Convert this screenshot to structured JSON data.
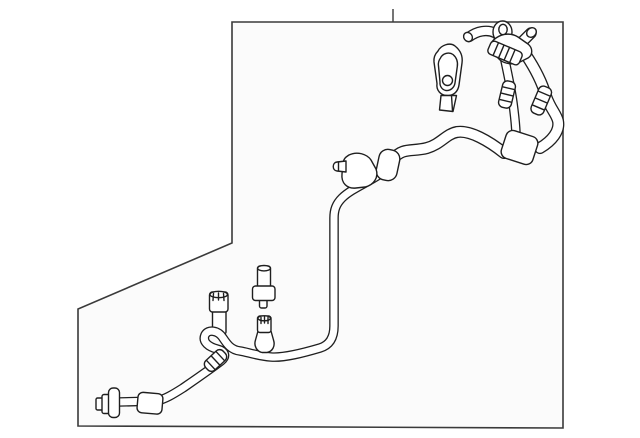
{
  "diagram": {
    "kind": "parts-line-drawing",
    "subject": "ac-suction-discharge-hose-assembly",
    "canvas": {
      "width": 640,
      "height": 438,
      "background": "#ffffff"
    },
    "colors": {
      "line": "#1f1f1f",
      "frame_line": "#3a3a3a",
      "frame_fill": "#fbfbfb",
      "part_fill": "#ffffff"
    },
    "frame": {
      "points": "232,22 563,22 563,428 78,426 78,309 232,243",
      "tick": {
        "x": 393,
        "y1": 9,
        "y2": 22
      }
    },
    "under": [
      {
        "name": "service-port-neck",
        "kind": "rect",
        "attrs": {
          "x": 212.5,
          "y": 306,
          "width": 13.5,
          "height": 28,
          "rx": 2
        }
      },
      {
        "name": "service-port-cap",
        "kind": "rect",
        "attrs": {
          "x": 209.5,
          "y": 292,
          "width": 18.5,
          "height": 20,
          "rx": 3
        }
      },
      {
        "name": "service-port-cap-top",
        "kind": "ellipse",
        "attrs": {
          "cx": 218.7,
          "cy": 294.5,
          "rx": 8.7,
          "ry": 3.2
        }
      },
      {
        "name": "port-knurl-tick-1",
        "kind": "line",
        "attrs": {
          "x1": 213.5,
          "y1": 293.5,
          "x2": 213,
          "y2": 300.5
        }
      },
      {
        "name": "port-knurl-tick-2",
        "kind": "line",
        "attrs": {
          "x1": 218.5,
          "y1": 293,
          "x2": 218.5,
          "y2": 300
        }
      },
      {
        "name": "port-knurl-tick-3",
        "kind": "line",
        "attrs": {
          "x1": 223.5,
          "y1": 293.5,
          "x2": 224,
          "y2": 300.5
        }
      }
    ],
    "tubes": [
      {
        "name": "manifold-gooseneck-tube",
        "w": 8,
        "d": "M469,37 C477,31 487,29 495,33 C502,37 507,43 510,51"
      },
      {
        "name": "service-port-stub",
        "w": 9,
        "d": "M521,43 L531,33"
      },
      {
        "name": "steep-tube-run",
        "w": 7,
        "d": "M504,56 C507,70 511,88 513,103 C515,118 516,127 516,136"
      },
      {
        "name": "right-loop-hose",
        "w": 9.5,
        "d": "M526,55 C534,67 542,82 546,96 C551,110 556,113 558,121 C560,131 552,141 540,148"
      },
      {
        "name": "upper-hose-run",
        "w": 9.5,
        "d": "M504,153 C489,141 470,130 457,132 C446,134 441,144 427,148 C412,152 403,147 393,159"
      },
      {
        "name": "lower-tube-run",
        "w": 7,
        "d": "M386,170 C372,181 352,188 342,198 C336,204 334,210 334,218 L334,326 C334,337 330,345 320,348 C303,353 284,358 271,357 C258,356 247,352 240,351 C231,350 227,344 223,338 C218,330 208,329 205,335 C202,342 209,347 217,349 C225,351 227,356 221,361 C212,368 196,379 183,388 C172,395 165,399 157,401 L118,402"
      }
    ],
    "details": [
      {
        "name": "bracket-eyelet-outer",
        "kind": "ellipse",
        "attrs": {
          "cx": 502.5,
          "cy": 32,
          "rx": 9.5,
          "ry": 11
        }
      },
      {
        "name": "bracket-eyelet-inner",
        "kind": "ellipse",
        "fill": "none",
        "attrs": {
          "cx": 503,
          "cy": 29.5,
          "rx": 4.2,
          "ry": 5.2
        }
      },
      {
        "name": "gooseneck-tip",
        "kind": "ellipse",
        "attrs": {
          "cx": 468,
          "cy": 37,
          "rx": 4.2,
          "ry": 4.8,
          "transform": "rotate(-35 468 37)"
        }
      },
      {
        "name": "manifold-bracket",
        "kind": "path",
        "attrs": {
          "d": "M496,38 C503,33 512,33 518,37 L528,44 C533,48 533,55 528,58 L520,62 C513,65 505,64 500,60 L493,53 C489,48 490,42 496,38 Z"
        }
      },
      {
        "name": "port-stub-cap",
        "kind": "ellipse",
        "attrs": {
          "cx": 531.5,
          "cy": 32.5,
          "rx": 4.4,
          "ry": 5.2,
          "transform": "rotate(45 531.5 32.5)"
        }
      },
      {
        "name": "crimp-ferrule",
        "kind": "rect",
        "attrs": {
          "x": 488,
          "y": 46,
          "width": 34,
          "height": 14,
          "rx": 4,
          "transform": "rotate(23 505 53)"
        }
      },
      {
        "name": "ferrule-rib-1",
        "kind": "line",
        "attrs": {
          "x1": 495,
          "y1": 46.5,
          "x2": 495,
          "y2": 59.5,
          "transform": "rotate(23 505 53)"
        }
      },
      {
        "name": "ferrule-rib-2",
        "kind": "line",
        "attrs": {
          "x1": 501,
          "y1": 46.5,
          "x2": 501,
          "y2": 59.5,
          "transform": "rotate(23 505 53)"
        }
      },
      {
        "name": "ferrule-rib-3",
        "kind": "line",
        "attrs": {
          "x1": 507,
          "y1": 46.5,
          "x2": 507,
          "y2": 59.5,
          "transform": "rotate(23 505 53)"
        }
      },
      {
        "name": "ferrule-rib-4",
        "kind": "line",
        "attrs": {
          "x1": 513,
          "y1": 46.5,
          "x2": 513,
          "y2": 59.5,
          "transform": "rotate(23 505 53)"
        }
      },
      {
        "name": "crimp-collar-a",
        "kind": "rect",
        "attrs": {
          "x": 500.5,
          "y": 81,
          "width": 13,
          "height": 27,
          "rx": 5,
          "transform": "rotate(13.5 507 94.5)"
        }
      },
      {
        "name": "collar-a-rib-1",
        "kind": "line",
        "attrs": {
          "x1": 501.5,
          "y1": 88,
          "x2": 512.5,
          "y2": 88,
          "transform": "rotate(13.5 507 94.5)"
        }
      },
      {
        "name": "collar-a-rib-2",
        "kind": "line",
        "attrs": {
          "x1": 501.5,
          "y1": 94.5,
          "x2": 512.5,
          "y2": 94.5,
          "transform": "rotate(13.5 507 94.5)"
        }
      },
      {
        "name": "collar-a-rib-3",
        "kind": "line",
        "attrs": {
          "x1": 501.5,
          "y1": 101,
          "x2": 512.5,
          "y2": 101,
          "transform": "rotate(13.5 507 94.5)"
        }
      },
      {
        "name": "crimp-collar-b",
        "kind": "rect",
        "attrs": {
          "x": 534.5,
          "y": 86,
          "width": 13.5,
          "height": 29,
          "rx": 5,
          "transform": "rotate(23 541.2 100.5)"
        }
      },
      {
        "name": "collar-b-rib-1",
        "kind": "line",
        "attrs": {
          "x1": 535.5,
          "y1": 93,
          "x2": 547,
          "y2": 93,
          "transform": "rotate(23 541.2 100.5)"
        }
      },
      {
        "name": "collar-b-rib-2",
        "kind": "line",
        "attrs": {
          "x1": 535.5,
          "y1": 100.5,
          "x2": 547,
          "y2": 100.5,
          "transform": "rotate(23 541.2 100.5)"
        }
      },
      {
        "name": "collar-b-rib-3",
        "kind": "line",
        "attrs": {
          "x1": 535.5,
          "y1": 108,
          "x2": 547,
          "y2": 108,
          "transform": "rotate(23 541.2 100.5)"
        }
      },
      {
        "name": "junction-sleeve",
        "kind": "rect",
        "attrs": {
          "x": 503,
          "y": 133,
          "width": 33,
          "height": 29,
          "rx": 7,
          "transform": "rotate(18 519.5 147.5)"
        }
      },
      {
        "name": "ring-clamp",
        "kind": "rect",
        "attrs": {
          "x": 377.5,
          "y": 149.5,
          "width": 21,
          "height": 31,
          "rx": 9,
          "transform": "rotate(12 388 165)"
        }
      },
      {
        "name": "clamp-block",
        "kind": "path",
        "attrs": {
          "d": "M349,155 C357,151 367,154 371,160 L376,169 C379,177 374,185 365,187 L356,188 C347,189 341,183 342,174 L343,163 C344,158 346,157 349,155 Z"
        }
      },
      {
        "name": "mount-nipple",
        "kind": "path",
        "attrs": {
          "d": "M346,161 L337,162 C332,162.5 332,170.5 337,171 L346,172 Z"
        }
      },
      {
        "name": "nipple-tip-line",
        "kind": "line",
        "attrs": {
          "x1": 338.5,
          "y1": 162,
          "x2": 338.5,
          "y2": 170.8
        }
      },
      {
        "name": "crimp-collar-c",
        "kind": "rect",
        "attrs": {
          "x": 203.5,
          "y": 354,
          "width": 24,
          "height": 13,
          "rx": 5,
          "transform": "rotate(-43 215.5 360.5)"
        }
      },
      {
        "name": "collar-c-rib-1",
        "kind": "line",
        "attrs": {
          "x1": 209,
          "y1": 354.5,
          "x2": 209,
          "y2": 366.5,
          "transform": "rotate(-43 215.5 360.5)"
        }
      },
      {
        "name": "collar-c-rib-2",
        "kind": "line",
        "attrs": {
          "x1": 215.5,
          "y1": 354.5,
          "x2": 215.5,
          "y2": 366.5,
          "transform": "rotate(-43 215.5 360.5)"
        }
      },
      {
        "name": "collar-c-rib-3",
        "kind": "line",
        "attrs": {
          "x1": 222,
          "y1": 354.5,
          "x2": 222,
          "y2": 366.5,
          "transform": "rotate(-43 215.5 360.5)"
        }
      },
      {
        "name": "charge-valve-body",
        "kind": "path",
        "attrs": {
          "d": "M258,331 L255.5,340 C253.5,346 257,351.5 262,352.5 L267,352.5 C272.5,351.5 275.5,346 273.5,340 L271,331 Z"
        }
      },
      {
        "name": "charge-valve-cap",
        "kind": "rect",
        "attrs": {
          "x": 257.5,
          "y": 316,
          "width": 13.5,
          "height": 16.5,
          "rx": 2.5
        }
      },
      {
        "name": "charge-valve-cap-top",
        "kind": "ellipse",
        "attrs": {
          "cx": 264.2,
          "cy": 318.3,
          "rx": 6.3,
          "ry": 2.5
        }
      },
      {
        "name": "valve-knurl-tick-1",
        "kind": "line",
        "attrs": {
          "x1": 261,
          "y1": 317.5,
          "x2": 261,
          "y2": 323.5
        }
      },
      {
        "name": "valve-knurl-tick-2",
        "kind": "line",
        "attrs": {
          "x1": 264.5,
          "y1": 317,
          "x2": 264.5,
          "y2": 323
        }
      },
      {
        "name": "valve-knurl-tick-3",
        "kind": "line",
        "attrs": {
          "x1": 268,
          "y1": 317.5,
          "x2": 268,
          "y2": 323.5
        }
      },
      {
        "name": "bolt-tip",
        "kind": "rect",
        "attrs": {
          "x": 259.5,
          "y": 297,
          "width": 7.5,
          "height": 11,
          "rx": 2
        }
      },
      {
        "name": "bolt-stud",
        "kind": "rect",
        "attrs": {
          "x": 257.5,
          "y": 266,
          "width": 13,
          "height": 23,
          "rx": 2.5
        }
      },
      {
        "name": "bolt-stud-top",
        "kind": "ellipse",
        "attrs": {
          "cx": 264,
          "cy": 268.2,
          "rx": 6.4,
          "ry": 2.7
        }
      },
      {
        "name": "bolt-flange",
        "kind": "rect",
        "attrs": {
          "x": 252.5,
          "y": 286,
          "width": 22.5,
          "height": 14.5,
          "rx": 3
        }
      },
      {
        "name": "protective-cap-body",
        "kind": "path",
        "attrs": {
          "d": "M438,51 C441,45 450,42 455,46 C460,50 463,56 462,63 L459,85 C458,92 453,96 447,95.5 C441,95.5 436,90.5 437,83.5 L434,62 C433.5,57 435,54 438,51 Z"
        }
      },
      {
        "name": "protective-cap-inner",
        "kind": "path",
        "fill": "none",
        "attrs": {
          "d": "M440.5,58 C442.5,53.5 449,51.5 453,54.5 C456.5,57.5 458,62 457.3,66.5 L455,83 C454.2,88 450,91 446,90.5 C442.5,90 439.5,86.5 440,82 L438.5,66 C438,63 439,60 440.5,58 Z"
        }
      },
      {
        "name": "protective-cap-hole",
        "kind": "circle",
        "attrs": {
          "cx": 447.5,
          "cy": 80.5,
          "r": 5
        }
      },
      {
        "name": "protective-cap-stem",
        "kind": "path",
        "attrs": {
          "d": "M441,95.5 L439.5,110 L453,111.5 L456.5,95.5 Z"
        }
      },
      {
        "name": "cap-stem-edge",
        "kind": "line",
        "attrs": {
          "x1": 451.5,
          "y1": 95.5,
          "x2": 452.5,
          "y2": 111
        }
      },
      {
        "name": "end-nut-small",
        "kind": "rect",
        "attrs": {
          "x": 96,
          "y": 398,
          "width": 8,
          "height": 12,
          "rx": 1.5
        }
      },
      {
        "name": "end-nut-large",
        "kind": "rect",
        "attrs": {
          "x": 102,
          "y": 394.5,
          "width": 8,
          "height": 19,
          "rx": 2
        }
      },
      {
        "name": "end-flange",
        "kind": "rect",
        "attrs": {
          "x": 108.5,
          "y": 388,
          "width": 11,
          "height": 29.5,
          "rx": 4.5
        }
      },
      {
        "name": "crimp-sleeve",
        "kind": "rect",
        "attrs": {
          "x": 137.5,
          "y": 393,
          "width": 25,
          "height": 20.5,
          "rx": 5,
          "transform": "rotate(5 150 403)"
        }
      }
    ]
  }
}
